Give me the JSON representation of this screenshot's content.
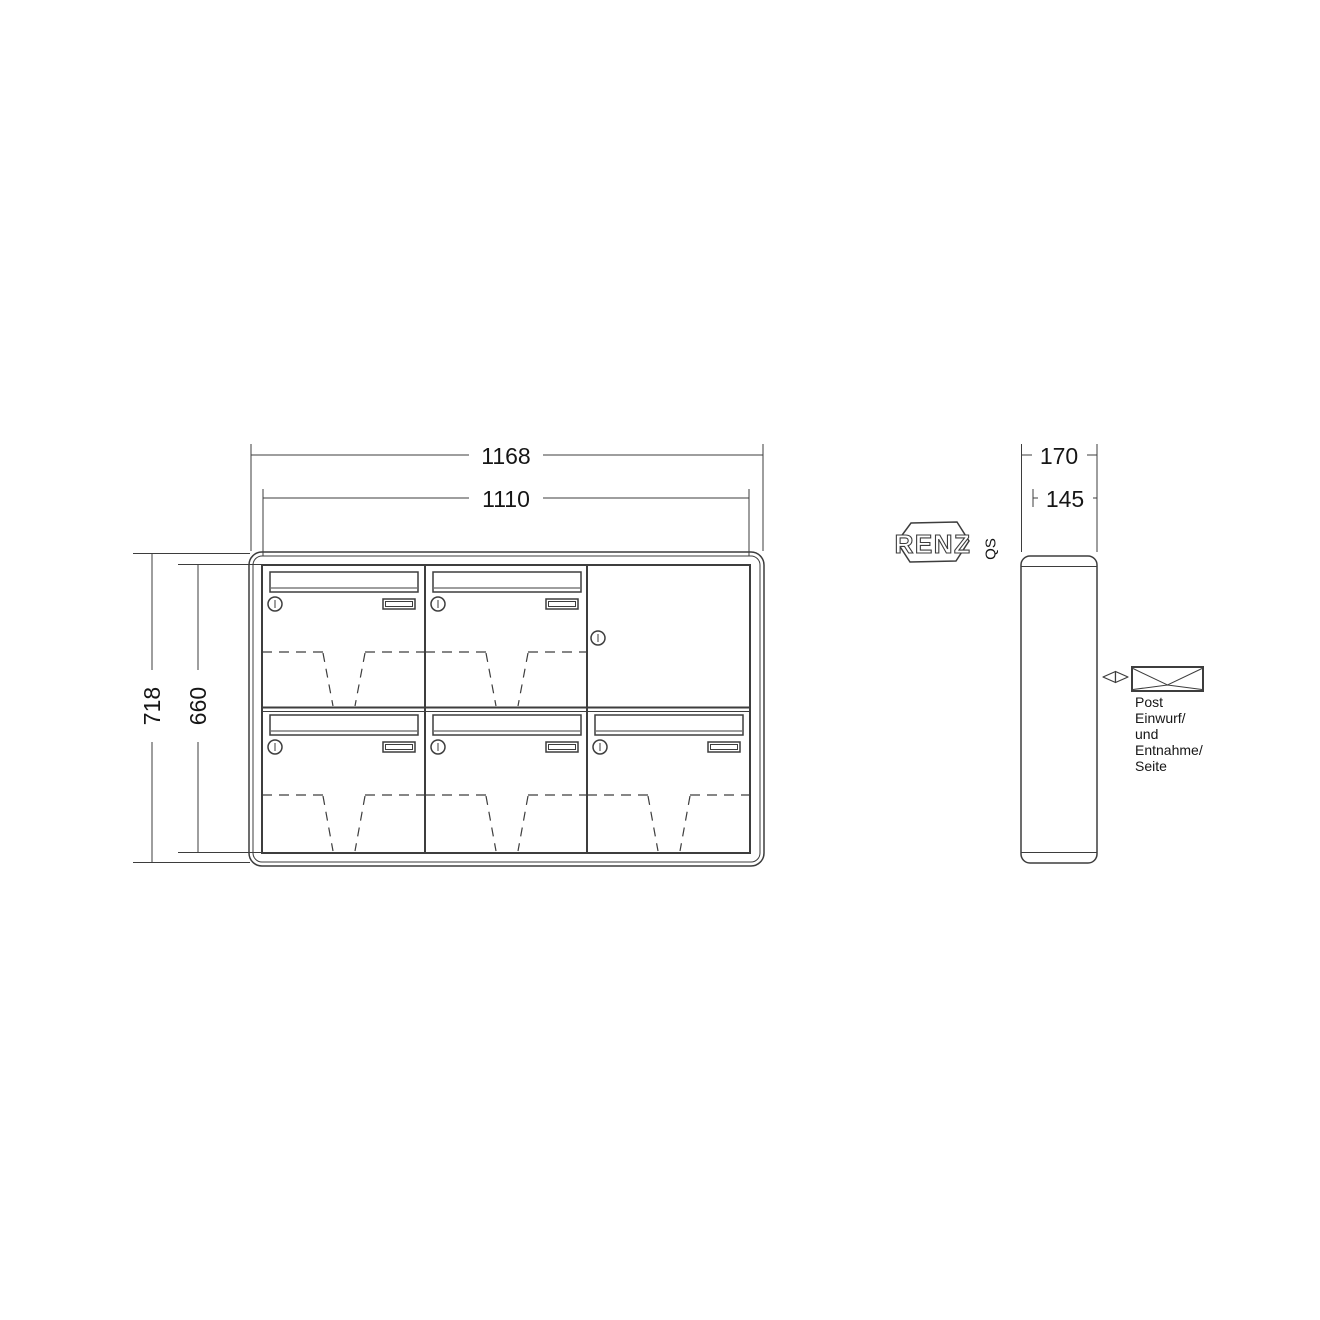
{
  "page": {
    "background": "#ffffff"
  },
  "drawing": {
    "type": "mailbox-technical-drawing",
    "dimensions": {
      "front": {
        "width_outer": "1168",
        "width_inner": "1110",
        "height_outer": "718",
        "height_inner": "660"
      },
      "side": {
        "depth_outer": "170",
        "depth_inner": "145"
      }
    },
    "brand": {
      "logo": "RENZ",
      "qs": "QS"
    },
    "annotation": {
      "lines": [
        "Post",
        "Einwurf/",
        "und",
        "Entnahme/",
        "Seite"
      ]
    },
    "icons": {
      "envelope": "envelope-icon",
      "direction": "direction-indicator-icon",
      "lock": "lock-icon"
    },
    "counts": {
      "mailbox_doors": 5,
      "plain_doors": 1,
      "columns": 3,
      "rows": 2
    },
    "colors": {
      "line": "#3d3d3d",
      "text": "#161616",
      "background": "#ffffff"
    }
  }
}
